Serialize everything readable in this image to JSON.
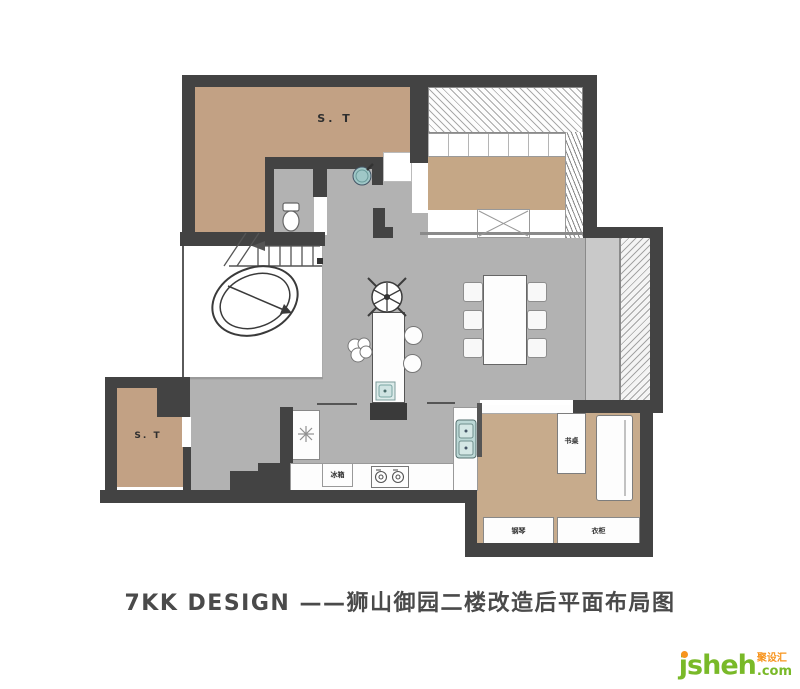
{
  "footer": {
    "title": "7KK DESIGN ——狮山御园二楼改造后平面布局图"
  },
  "logo": {
    "brand": "jsheh",
    "tld": ".com",
    "tagline": "聚设汇"
  },
  "plan": {
    "labels": {
      "storage_top": "S. T",
      "storage_bottom": "S. T",
      "fridge": "冰箱",
      "desk": "书桌",
      "piano": "钢琴",
      "wardrobe": "衣柜"
    },
    "colors": {
      "wall": "#434343",
      "floor_tan": "#c2a184",
      "floor_tan_light": "#c7ab8c",
      "floor_gray": "#b2b2b2",
      "fixture_teal": "#bcd8d6",
      "logo_green": "#79b928",
      "logo_orange": "#f7941d"
    }
  }
}
